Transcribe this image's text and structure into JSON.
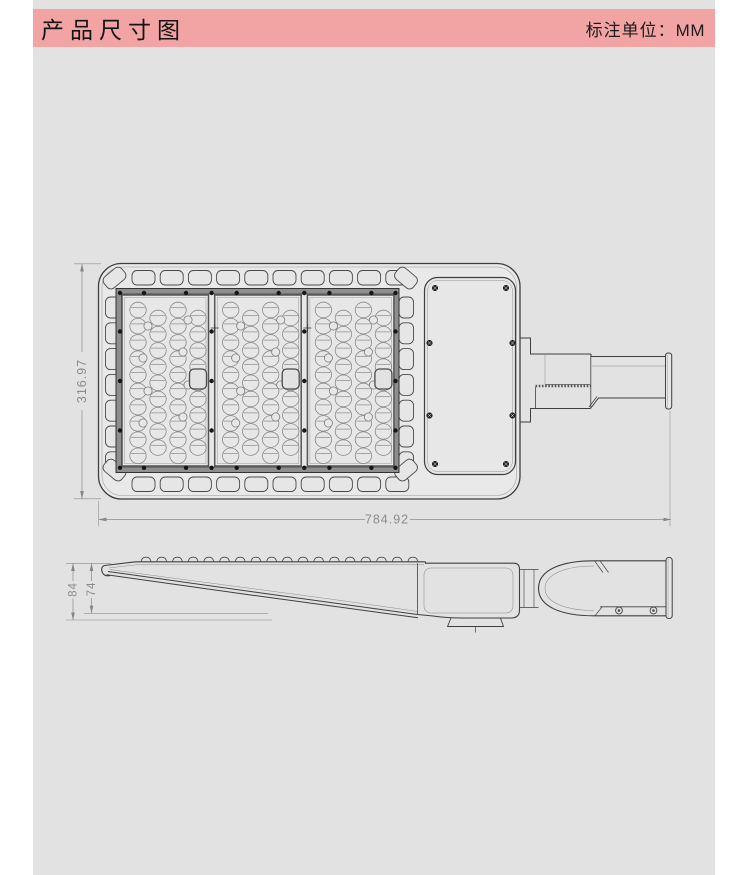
{
  "header": {
    "title": "产品尺寸图",
    "unit_label": "标注单位：",
    "unit_value": "MM"
  },
  "drawing": {
    "dimensions": {
      "width": "784.92",
      "height": "316.97",
      "side_total_height": "84",
      "side_body_height": "74"
    },
    "unit": "MM"
  },
  "colors": {
    "header_pink": "#f2a3a4",
    "content_bg": "#e2e2e2",
    "page_bg": "#ffffff",
    "outline": "#3f3f3f",
    "dim_line": "#8c8c8c"
  }
}
